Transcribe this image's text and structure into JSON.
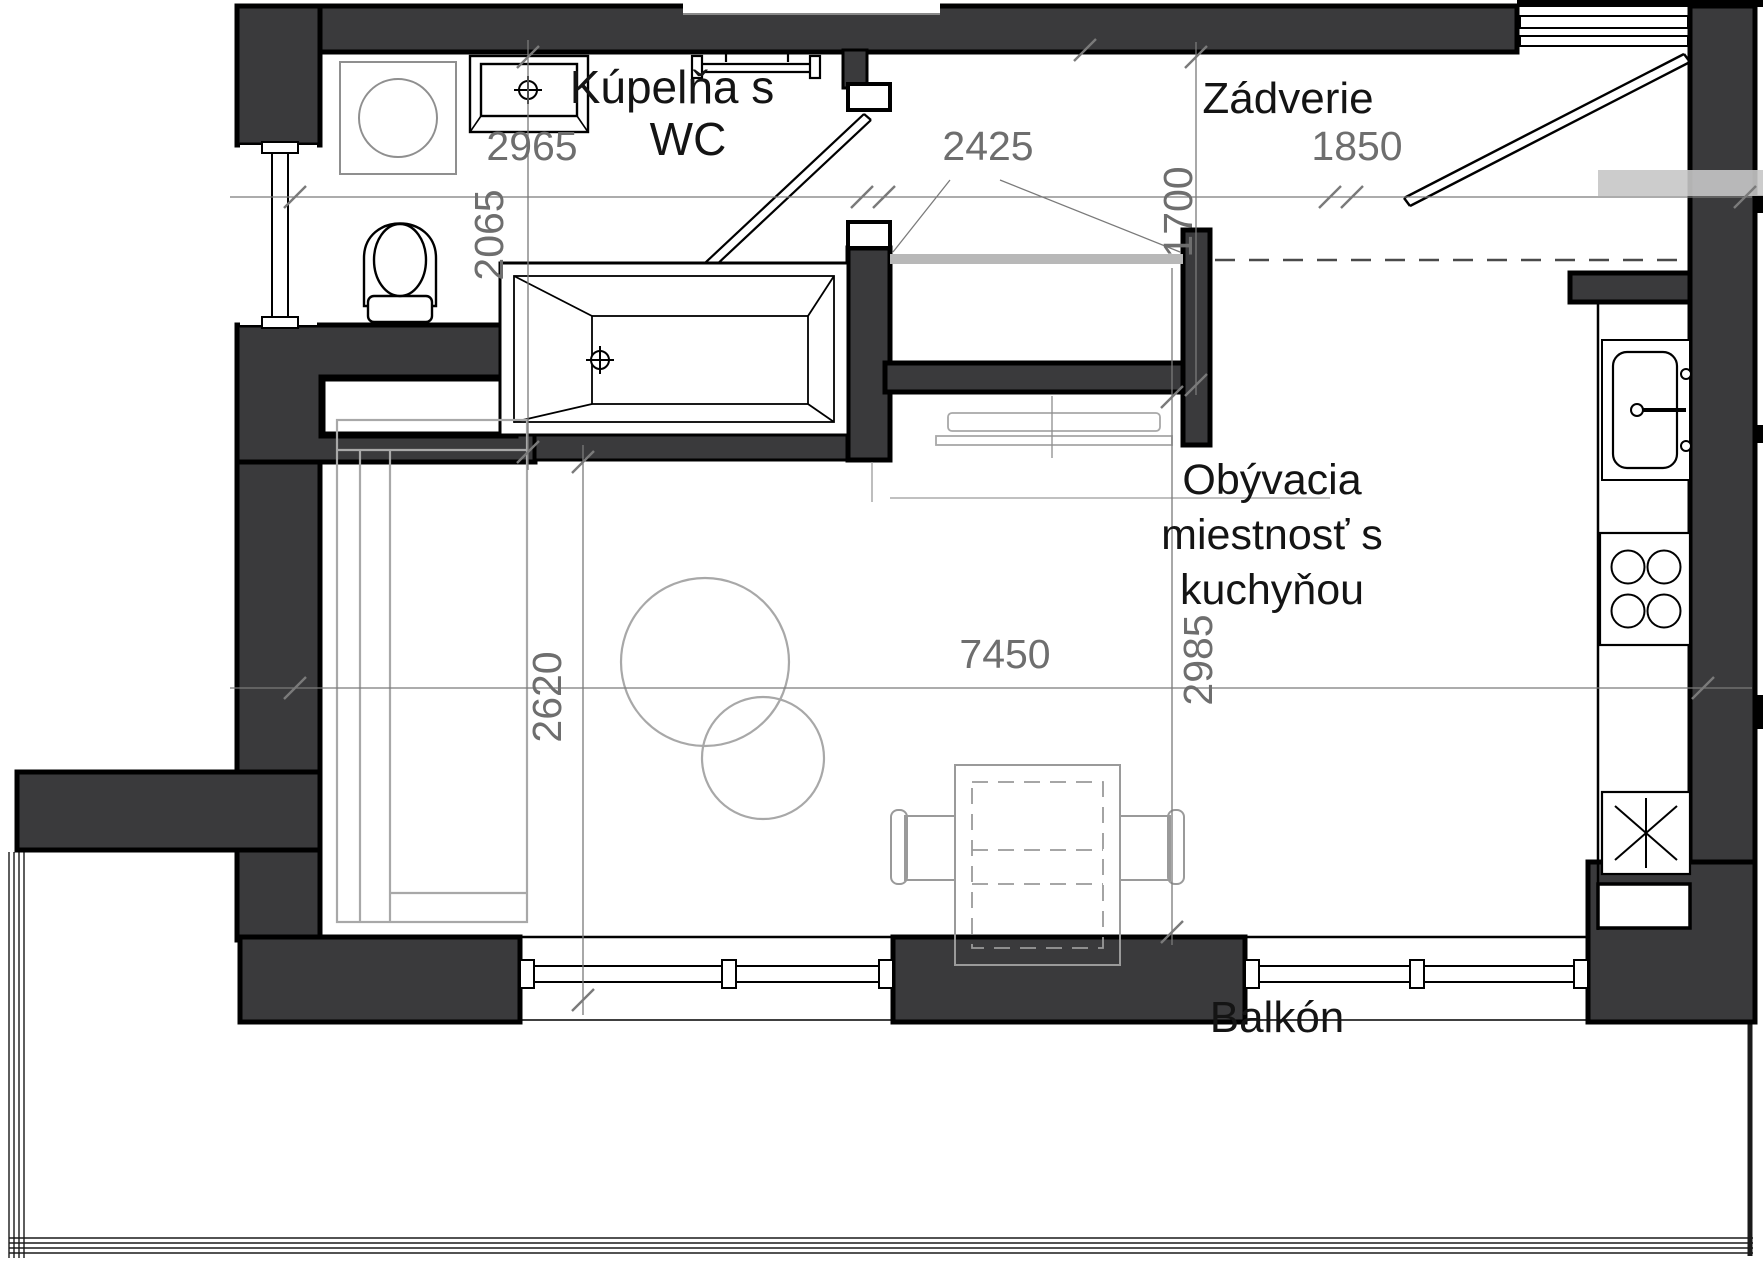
{
  "plan_title": "Apartment floor plan",
  "colors": {
    "wall_fill": "#3a3a3c",
    "wall_stroke": "#000000",
    "furniture_gray": "#a8a8a8",
    "dimension_gray": "#6e6e6e",
    "beam_gray": "#b8b8b8",
    "band_gray": "#c6c6c6",
    "label_black": "#141414"
  },
  "rooms": {
    "bathroom": {
      "name_line1": "Kúpelňa s",
      "name_line2": "WC"
    },
    "hallway": {
      "name": "Zádverie"
    },
    "living": {
      "name_line1": "Obývacia",
      "name_line2": "miestnosť s",
      "name_line3": "kuchyňou"
    },
    "balcony": {
      "name": "Balkón"
    }
  },
  "dimensions_mm": {
    "bathroom_width": "2965",
    "bathroom_depth": "2065",
    "hall_opening_width": "2425",
    "hall_depth": "1700",
    "entry_zone_width": "1850",
    "sofa_zone_depth": "2620",
    "living_total_width": "7450",
    "living_depth": "2985"
  },
  "fixtures": {
    "washing_machine": "washing-machine",
    "washbasin": "washbasin",
    "towel_radiator": "towel-radiator",
    "toilet": "toilet",
    "bathtub": "bathtub",
    "wall_niche": "wall-niche",
    "sofa": "sofa",
    "armchair": "round-armchair",
    "side_table": "round-side-table",
    "tv_lowboard": "tv-lowboard",
    "dining_table": "dining-table",
    "chair_left": "chair",
    "chair_right": "chair",
    "kitchen_sink": "kitchen-sink",
    "stove": "stove-4-burners",
    "fridge": "fridge"
  }
}
